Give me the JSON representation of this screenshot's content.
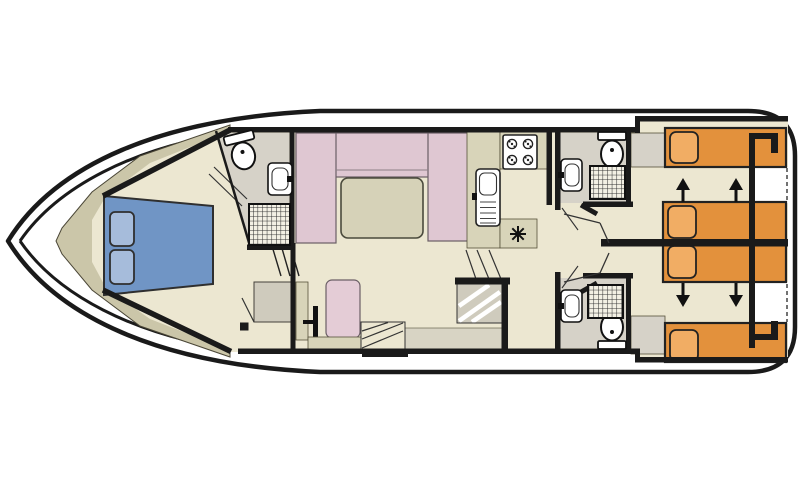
{
  "diagram": {
    "type": "houseboat-floor-plan",
    "colors": {
      "background": "#FFFFFF",
      "outline": "#1A1A1A",
      "floor": "#ECE7D1",
      "lining": "#CBC6A9",
      "counter": "#D8D4B9",
      "table": "#D6D2B8",
      "bath_floor": "#D6D2C8",
      "gray_block": "#CFCBBD",
      "gray_light": "#D8D4C4",
      "sofa_pink": "#DFC7D2",
      "seat_pink": "#E4CCD6",
      "bed_blue": "#7095C5",
      "pillow_blue": "#A6BCDB",
      "bed_orange": "#E3913C",
      "pillow_orange": "#F1AD64",
      "fixture_white": "#FFFFFF"
    },
    "icons": {
      "toilet": "toilet-icon",
      "shower": "shower-grid-icon",
      "washbasin": "washbasin-icon",
      "stove": "stove-4-burner-icon",
      "galley_sink": "galley-sink-icon",
      "vent": "vent-star-icon",
      "helm": "steering-wheel-icon",
      "stairs": "stairs-icon",
      "slide_arrow": "bed-slide-arrow-icon"
    },
    "layout_counts": {
      "bow_double_bed": 1,
      "bow_pillows": 2,
      "saloon_sofa_sections": 3,
      "saloon_table": 1,
      "stove_burners": 4,
      "bathrooms": 3,
      "aft_beds": 4,
      "slide_arrows": 4
    }
  }
}
